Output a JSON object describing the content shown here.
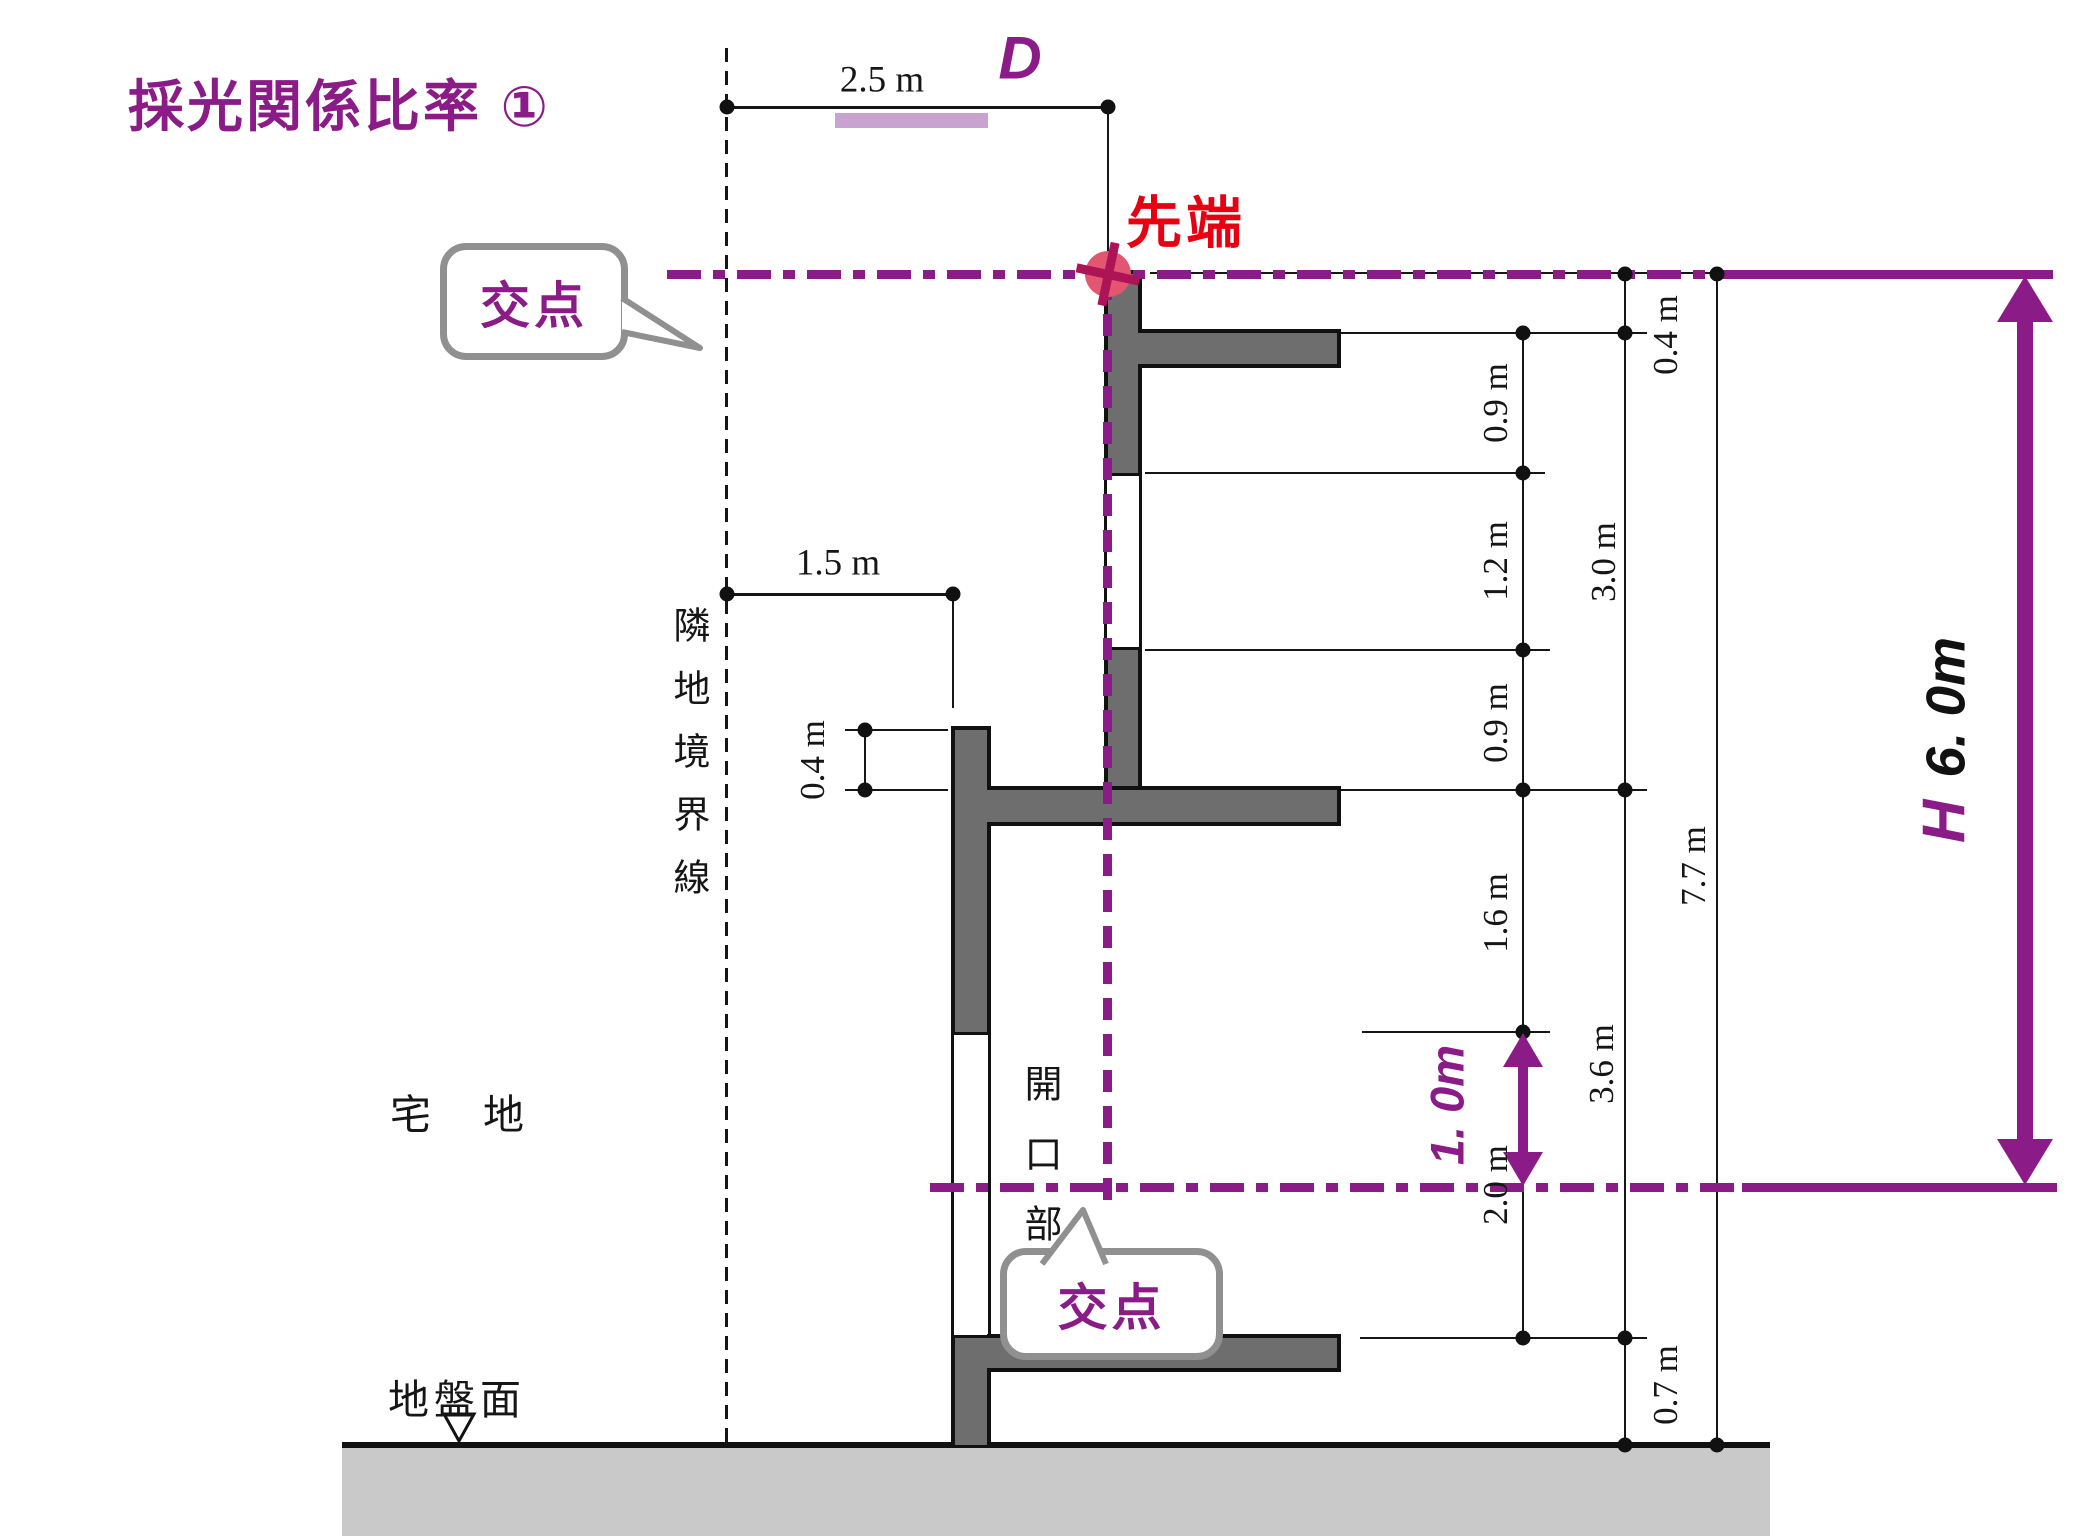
{
  "title": "採光関係比率 ①",
  "top": {
    "d_label": "D",
    "offset_dim": "2.5 m"
  },
  "left": {
    "offset_dim": "1.5 m",
    "parapet_dim": "0.4 m",
    "boundary_label": "隣地境界線",
    "site_label": "宅地",
    "ground_label": "地盤面"
  },
  "building": {
    "opening_label": "開口部"
  },
  "markers": {
    "tip_label": "先端",
    "intersection_top": "交点",
    "intersection_bottom": "交点"
  },
  "dims": {
    "d04": "0.4 m",
    "d09a": "0.9 m",
    "d12": "1.2 m",
    "d09b": "0.9 m",
    "d30": "3.0 m",
    "d16": "1.6 m",
    "d20": "2.0 m",
    "d36": "3.6 m",
    "d07": "0.7 m",
    "d77": "7.7 m"
  },
  "arrows": {
    "window_height": "1. 0m",
    "h_label": "H",
    "h_value": "6. 0m"
  },
  "colors": {
    "accent_purple": "#8a1b87",
    "highlight_lavender": "#c9a3cf",
    "tip_red": "#e60012",
    "marker_rose": "#e35672",
    "wall_gray": "#6e6e6e",
    "ground_gray": "#c9c9c9",
    "bubble_border_gray": "#909090"
  }
}
